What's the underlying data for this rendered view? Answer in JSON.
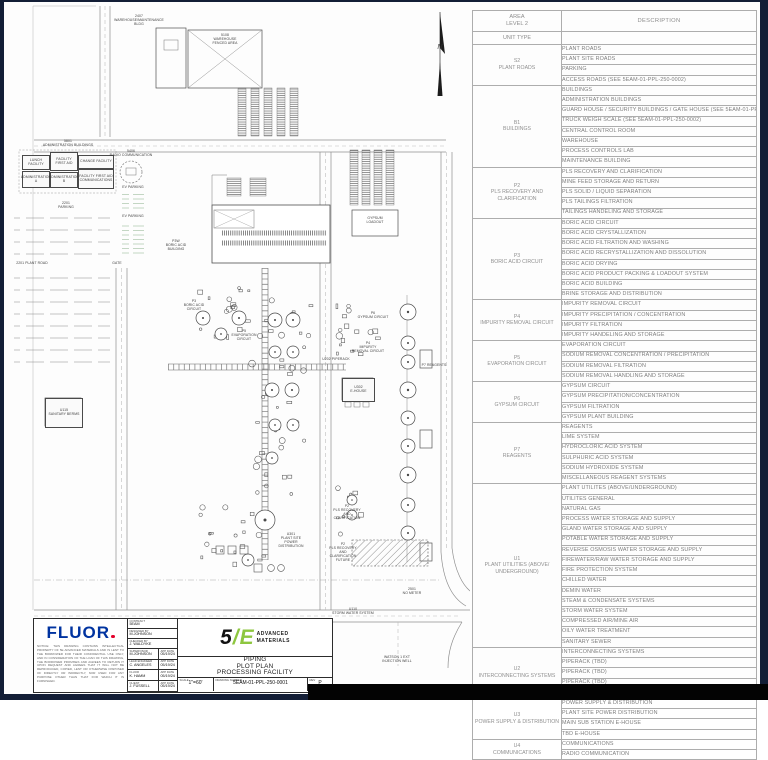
{
  "drawing": {
    "north_label": "N",
    "labels": [
      {
        "id": "warehouse-maint",
        "text": "2407\nWAREHOUSE/MAINTENANCE\nBLDG"
      },
      {
        "id": "warehouse-fenced",
        "text": "5108\nWAREHOUSE\nFENCED AREA"
      },
      {
        "id": "admin-header",
        "text": "5801\nADMINISTRATION BUILDINGS"
      },
      {
        "id": "lunch-facility",
        "text": "LUNCH FACILITY"
      },
      {
        "id": "facility-first-aid",
        "text": "FACILITY\nFIRST AID"
      },
      {
        "id": "change-facility",
        "text": "CHANGE FACILITY"
      },
      {
        "id": "administration-a",
        "text": "ADMINISTRATION\nA"
      },
      {
        "id": "administration-b",
        "text": "ADMINISTRATION\nB"
      },
      {
        "id": "first-aid-communications",
        "text": "FACILITY FIRST AID\nCOMMUNICATIONS"
      },
      {
        "id": "radio-communication",
        "text": "5406\nRADIO COMMUNICATION"
      },
      {
        "id": "ev-parking-1",
        "text": "EV PARKING"
      },
      {
        "id": "ev-parking-2",
        "text": "EV PARKING"
      },
      {
        "id": "parking",
        "text": "2201\nPARKING"
      },
      {
        "id": "plant-road",
        "text": "2201 PLANT ROAD"
      },
      {
        "id": "gate",
        "text": "GATE"
      },
      {
        "id": "sanitary-berms",
        "text": "U115\nSANITARY BERMS"
      },
      {
        "id": "boric-acid-building",
        "text": "P3W\nBORIC ACID\nBUILDING"
      },
      {
        "id": "boric-acid-circuit",
        "text": "P3\nBORIC ACID\nCIRCUIT"
      },
      {
        "id": "gypsum-loadout",
        "text": "GYPSUM\nLOADOUT"
      },
      {
        "id": "gypsum-circuit",
        "text": "P6\nGYPSUM CIRCUIT"
      },
      {
        "id": "impurity-removal",
        "text": "P4\nIMPURITY\nREMOVAL CIRCUIT"
      },
      {
        "id": "evaporation-circuit",
        "text": "P5\nEVAPORATION\nCIRCUIT"
      },
      {
        "id": "piperack",
        "text": "U202 PIPERACK"
      },
      {
        "id": "e-house",
        "text": "U302\nE-HOUSE"
      },
      {
        "id": "reagents",
        "text": "P7 REAGENTS"
      },
      {
        "id": "power-distribution",
        "text": "U301\nPLANT SITE\nPOWER\nDISTRIBUTION"
      },
      {
        "id": "pls-recovery",
        "text": "P2\nPLS RECOVERY\nAND\nCLARIFICATION"
      },
      {
        "id": "pls-recovery-future",
        "text": "P2\nPLS RECOVERY AND\nCLARIFICATION\nFUTURE"
      },
      {
        "id": "storm-water",
        "text": "U110\nSTORM WATER SYSTEM"
      },
      {
        "id": "no-meter",
        "text": "2501\nNO METER"
      },
      {
        "id": "injection-well",
        "text": "WATSON 1 EXT\nINJECTION WELL"
      }
    ]
  },
  "legend_table": {
    "header": {
      "area_line1": "AREA",
      "area_line2": "LEVEL 2",
      "unit_type": "UNIT TYPE",
      "description": "DESCRIPTION"
    },
    "groups": [
      {
        "code": "S2",
        "name": "PLANT ROADS",
        "rows": [
          "PLANT ROADS",
          "PLANT SITE ROADS",
          "PARKING",
          "ACCESS ROADS (SEE 5EAM-01-PPL-250-0002)"
        ]
      },
      {
        "code": "B1",
        "name": "BUILDINGS",
        "rows": [
          "BUILDINGS",
          "ADMINISTRATION BUILDINGS",
          "GUARD HOUSE / SECURITY BUILDINGS / GATE HOUSE (SEE 5EAM-01-PPL-250-0002)",
          "TRUCK WEIGH SCALE (SEE 5EAM-01-PPL-250-0002)",
          "CENTRAL CONTROL ROOM",
          "WAREHOUSE",
          "PROCESS CONTROLS LAB",
          "MAINTENANCE BUILDING"
        ]
      },
      {
        "code": "P2",
        "name": "PLS RECOVERY AND CLARIFICATION",
        "rows": [
          "PLS RECOVERY AND CLARIFICATION",
          "MINE FEED STORAGE AND RETURN",
          "PLS SOLID / LIQUID SEPARATION",
          "PLS TAILINGS FILTRATION",
          "TAILINGS HANDELING AND STORAGE"
        ]
      },
      {
        "code": "P3",
        "name": "BORIC ACID CIRCUIT",
        "rows": [
          "BORIC ACID CIRCUIT",
          "BORIC ACID CRYSTALLIZATION",
          "BORIC ACID FILTRATION AND WASHING",
          "BORIC ACID RECRYSTALLIZATION AND DISSOLUTION",
          "BORIC ACID DRYING",
          "BORIC ACID PRODUCT PACKING & LOADOUT SYSTEM",
          "BORIC ACID BUILDING",
          "BRINE STORAGE AND DISTRIBUTION"
        ]
      },
      {
        "code": "P4",
        "name": "IMPURITY REMOVAL CIRCUIT",
        "rows": [
          "IMPURITY REMOVAL CIRCUIT",
          "IMPURITY PRECIPITATION / CONCENTRATION",
          "IMPURITY FILTRATION",
          "IMPURITY HANDELING AND STORAGE"
        ]
      },
      {
        "code": "P5",
        "name": "EVAPORATION CIRCUIT",
        "rows": [
          "EVAPORATION CIRCUIT",
          "SODIUM REMOVAL CONCENTRATION / PRECIPITATION",
          "SODIUM REMOVAL FILTRATION",
          "SODIUM REMOVAL HANDLING AND STORAGE"
        ]
      },
      {
        "code": "P6",
        "name": "GYPSUM CIRCUIT",
        "rows": [
          "GYPSUM CIRCUIT",
          "GYPSUM PRECIPITATION/CONCENTRATION",
          "GYPSUM FILTRATION",
          "GYPSUM PLANT BUILDING"
        ]
      },
      {
        "code": "P7",
        "name": "REAGENTS",
        "rows": [
          "REAGENTS",
          "LIME SYSTEM",
          "HYDROCLORIC ACID SYSTEM",
          "SULPHURIC ACID SYSTEM",
          "SODIUM HYDROXIDE SYSTEM",
          "MISCELLANEOUS REAGENT SYSTEMS"
        ]
      },
      {
        "code": "U1",
        "name": "PLANT UTILITIES (ABOVE/ UNDERGROUND)",
        "rows": [
          "PLANT UTILITES (ABOVE/UNDERGROUND)",
          "UTILITES GENERAL",
          "NATURAL GAS",
          "PROCESS WATER STORAGE AND SUPPLY",
          "GLAND WATER STORAGE AND SUPPLY",
          "POTABLE WATER STORAGE AND SUPPLY",
          "REVERSE OSMOSIS WATER STORAGE AND SUPPLY",
          "FIREWATER/RAW WATER STORAGE AND SUPPLY",
          "FIRE PROTECTION SYSTEM",
          "CHILLED WATER",
          "DEMIN WATER",
          "STEAM & CONDENSATE SYSTEMS",
          "STORM WATER SYSTEM",
          "COMPRESSED AIR/MINE AIR",
          "OILY WATER TREATMENT",
          "SANITARY SEWER"
        ]
      },
      {
        "code": "U2",
        "name": "INTERCONNECTING SYSTEMS",
        "rows": [
          "INTERCONNECTING SYSTEMS",
          "PIPERACK (TBD)",
          "PIPERACK (TBD)",
          "PIPERACK  (TBD)",
          "PIPERACK UTILITIES"
        ]
      },
      {
        "code": "U3",
        "name": "POWER SUPPLY & DISTRIBUTION",
        "rows": [
          "POWER SUPPLY & DISTRIBUTION",
          "PLANT SITE POWER DISTRIBUTION",
          "MAIN SUB STATION E-HOUSE",
          "TBD E-HOUSE"
        ]
      },
      {
        "code": "U4",
        "name": "COMMUNICATIONS",
        "rows": [
          "COMMUNICATIONS",
          "RADIO COMMUNICATION"
        ]
      }
    ]
  },
  "title_block": {
    "company": "FLUOR",
    "notice": "NOTICE: THIS DRAWING CONTAINS INTELLECTUAL PROPERTY OF 5E ADVANCED MATERIALS AND IS LENT TO THE BORROWER FOR THEIR CONFIDENTIAL USE ONLY, AND IN CONSIDERATION OF THE LOAN OF THIS DRAWING, THE BORROWER PROMISES AND AGREES TO RETURN IT UPON REQUEST AND AGREES THAT IT WILL NOT BE REPRODUCED, COPIED, LENT OR OTHERWISE DISPOSED OF DIRECTLY OR INDIRECTLY, NOR USED FOR ANY PURPOSE OTHER THAN THAT FOR WHICH IT IS FURNISHED.",
    "contract_label": "CONTRACT",
    "contract_value": "5EAM",
    "designed_label": "DESIGNED BY",
    "designed_value": "M.JOHNSON",
    "checked_label": "CHECKED BY",
    "checked_value": "J. WALDYKE",
    "app_date_label": "APP DATE",
    "supervisor_label": "SUPERVISOR",
    "supervisor_value": "M.JOHNSON",
    "supervisor_date": "05/19/24",
    "lead_label": "LEAD ENGINEER",
    "lead_value": "C. ANGELES",
    "lead_date": "05/19/24",
    "fluor_label": "FLUOR",
    "fluor_value": "K. HAMM",
    "fluor_date": "05/19/24",
    "client_label": "CLIENT",
    "client_value": "J. FUSSELL",
    "client_date": "05/19/24",
    "logo_5": "5",
    "logo_slash": "/",
    "logo_e": "E",
    "logo_text_line1": "ADVANCED",
    "logo_text_line2": "MATERIALS",
    "title": "PIPING\nPLOT PLAN\nPROCESSING FACILITY",
    "scale_label": "SCALE",
    "scale_value": "1\"=60'",
    "drawing_number_label": "DRAWING NUMBER",
    "drawing_number": "5EAM-01-PPL-250-0001",
    "rev_label": "REV",
    "rev_value": "P",
    "logo_green": "#8dc63f",
    "fluor_blue": "#0033a0",
    "fluor_red": "#e4002b"
  }
}
